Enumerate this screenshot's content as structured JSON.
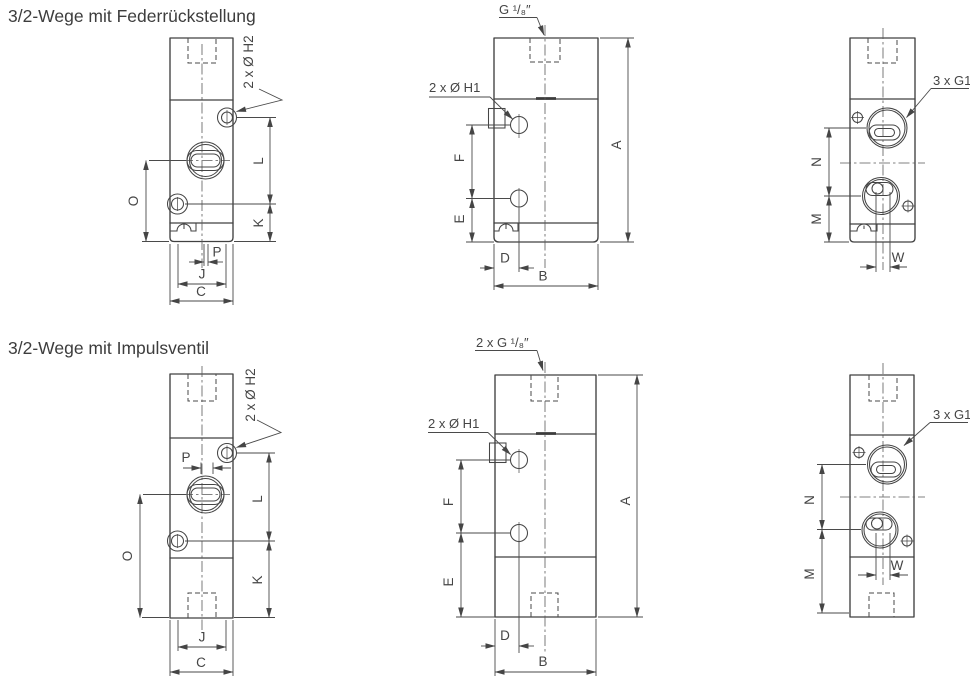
{
  "drawing": {
    "ink_color": "#454545",
    "background_color": "#ffffff"
  },
  "rows": [
    {
      "title": "3/2-Wege mit Federrückstellung",
      "left": {
        "callout_h2": "2 x Ø H2",
        "dims": {
          "O": "O",
          "L": "L",
          "K": "K",
          "P": "P",
          "J": "J",
          "C": "C"
        }
      },
      "front": {
        "callout_port": "G ¹/₈″",
        "callout_h1": "2 x Ø H1",
        "dims": {
          "A": "A",
          "F": "F",
          "E": "E",
          "D": "D",
          "B": "B"
        }
      },
      "right": {
        "callout_g1": "3 x G1",
        "dims": {
          "N": "N",
          "M": "M",
          "W": "W"
        }
      }
    },
    {
      "title": "3/2-Wege mit Impulsventil",
      "left": {
        "callout_h2": "2 x Ø H2",
        "dims": {
          "P": "P",
          "O": "O",
          "L": "L",
          "K": "K",
          "J": "J",
          "C": "C"
        }
      },
      "front": {
        "callout_port": "2 x G ¹/₈″",
        "callout_h1": "2 x Ø H1",
        "dims": {
          "A": "A",
          "F": "F",
          "E": "E",
          "D": "D",
          "B": "B"
        }
      },
      "right": {
        "callout_g1": "3 x G1",
        "dims": {
          "N": "N",
          "M": "M",
          "W": "W"
        }
      }
    }
  ]
}
